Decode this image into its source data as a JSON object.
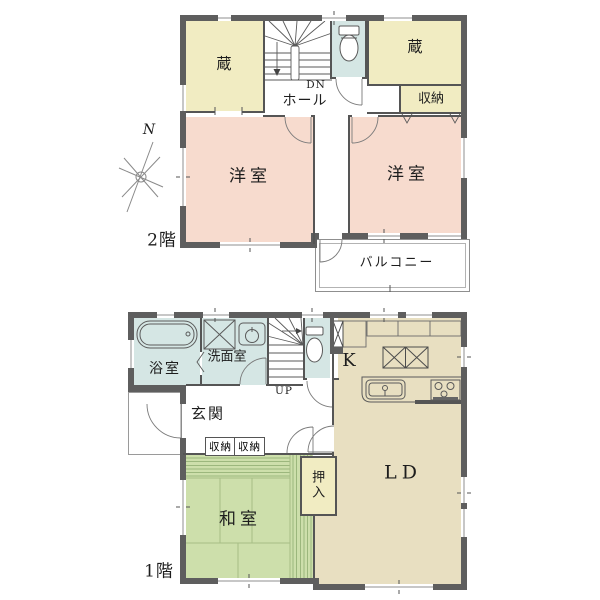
{
  "colors": {
    "wall": "#5e5e5e",
    "line": "#555555",
    "storage_yellow": "#f1ecc2",
    "bedroom_pink": "#f7dbce",
    "wet_area_blue": "#d5e6e4",
    "living_beige": "#e8dfc1",
    "tatami_green": "#cddfab",
    "tatami_stripe": "#9cb77d"
  },
  "floor2": {
    "label": "2階",
    "compass": "N",
    "rooms": {
      "storage_left": "蔵",
      "storage_right": "蔵",
      "closet": "収納",
      "hall": "ホール",
      "stairs_direction": "DN",
      "western_room_left": "洋室",
      "western_room_right": "洋室",
      "balcony": "バルコニー"
    }
  },
  "floor1": {
    "label": "1階",
    "rooms": {
      "bathroom": "浴室",
      "washroom": "洗面室",
      "stairs_direction": "UP",
      "entrance": "玄関",
      "closet_a": "収納",
      "closet_b": "収納",
      "japanese_room": "和室",
      "futon_closet": "押入",
      "living_dining": "LD",
      "kitchen": "K"
    }
  }
}
